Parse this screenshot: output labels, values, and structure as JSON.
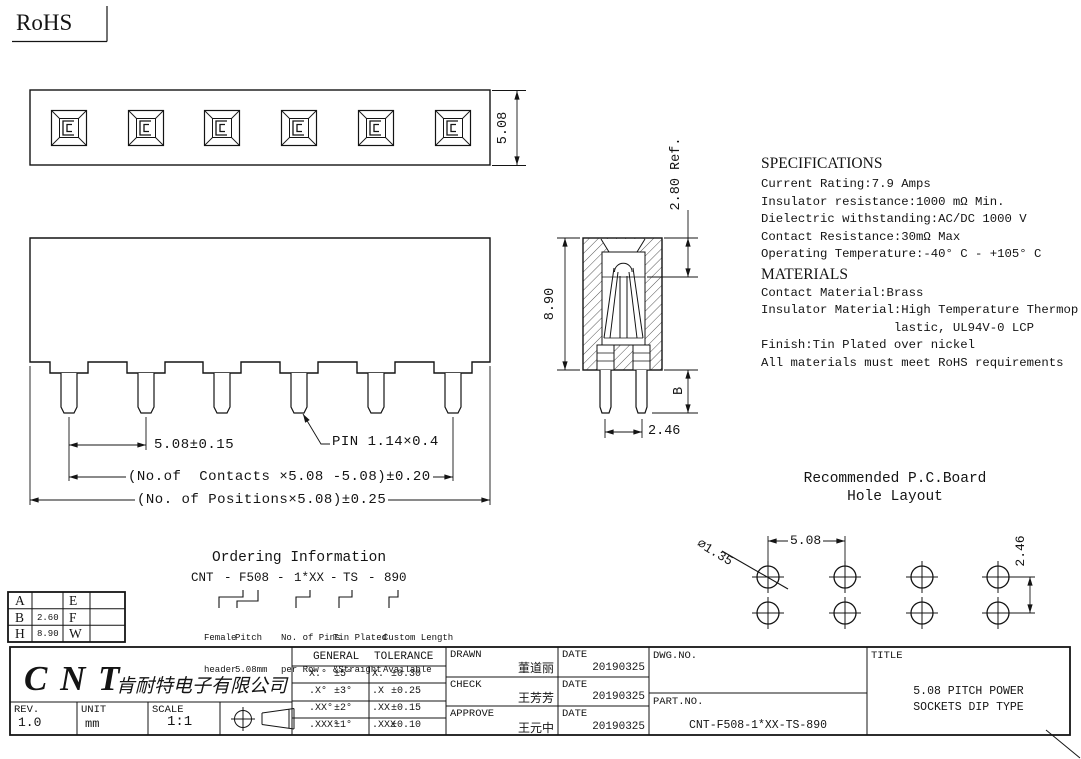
{
  "rohs": "RoHS",
  "specifications": {
    "heading": "SPECIFICATIONS",
    "lines": [
      "Current Rating:7.9 Amps",
      "Insulator resistance:1000 mΩ Min.",
      "Dielectric withstanding:AC/DC 1000 V",
      "Contact Resistance:30mΩ Max",
      "Operating Temperature:-40° C - +105° C"
    ],
    "materials_heading": "MATERIALS",
    "materials_lines": [
      "Contact Material:Brass",
      "Insulator Material:High Temperature Thermop",
      "                  lastic, UL94V-0 LCP",
      "Finish:Tin Plated over nickel",
      "All materials must meet RoHS requirements"
    ]
  },
  "dimensions": {
    "top_view_height": "5.08",
    "pin_pitch": "5.08±0.15",
    "pin_size": "PIN 1.14×0.4",
    "contacts_formula": "(No.of  Contacts ×5.08 -5.08)±0.20",
    "positions_formula": "(No. of Positions×5.08)±0.25",
    "side_height": "8.90",
    "side_ref": "2.80 Ref.",
    "side_b": "B",
    "side_pin_spacing": "2.46"
  },
  "pcb_layout": {
    "title_line1": "Recommended P.C.Board",
    "title_line2": "Hole Layout",
    "hole_diameter": "∅1.35",
    "hole_pitch": "5.08",
    "row_spacing": "2.46"
  },
  "ordering": {
    "title": "Ordering Information",
    "code": [
      "CNT",
      "-",
      "F508",
      "-",
      "1*XX",
      "-",
      "TS",
      "-",
      "890"
    ],
    "labels": [
      {
        "line1": "Female",
        "line2": "header"
      },
      {
        "line1": "Pitch",
        "line2": "5.08mm"
      },
      {
        "line1": "No. of Pins",
        "line2": "per Row"
      },
      {
        "line1": "Tin Plated",
        "line2": "&Straight"
      },
      {
        "line1": "Custom Length",
        "line2": "Available"
      }
    ]
  },
  "dim_table": {
    "rows": [
      {
        "k1": "A",
        "v1": "",
        "k2": "E",
        "v2": ""
      },
      {
        "k1": "B",
        "v1": "2.60",
        "k2": "F",
        "v2": ""
      },
      {
        "k1": "H",
        "v1": "8.90",
        "k2": "W",
        "v2": ""
      }
    ]
  },
  "title_block": {
    "logo": "C N T",
    "company": "肯耐特电子有限公司",
    "rev_label": "REV.",
    "rev": "1.0",
    "unit_label": "UNIT",
    "unit": "mm",
    "scale_label": "SCALE",
    "scale": "1:1",
    "tolerance": {
      "header_left": "GENERAL",
      "header_right": "TOLERANCE",
      "rows": [
        {
          "a": "X.°",
          "av": "±5°",
          "b": "X.",
          "bv": "±0.30"
        },
        {
          "a": ".X°",
          "av": "±3°",
          "b": ".X",
          "bv": "±0.25"
        },
        {
          "a": ".XX°",
          "av": "±2°",
          "b": ".XX",
          "bv": "±0.15"
        },
        {
          "a": ".XXX°",
          "av": "±1°",
          "b": ".XXX",
          "bv": "±0.10"
        }
      ]
    },
    "drawn_label": "DRAWN",
    "drawn": "董道丽",
    "check_label": "CHECK",
    "check": "王芳芳",
    "approve_label": "APPROVE",
    "approve": "王元中",
    "date_label": "DATE",
    "drawn_date": "20190325",
    "check_date": "20190325",
    "approve_date": "20190325",
    "dwg_label": "DWG.NO.",
    "part_label": "PART.NO.",
    "part_no": "CNT-F508-1*XX-TS-890",
    "title_label": "TITLE",
    "title_line1": "5.08 PITCH POWER",
    "title_line2": "SOCKETS DIP TYPE"
  }
}
